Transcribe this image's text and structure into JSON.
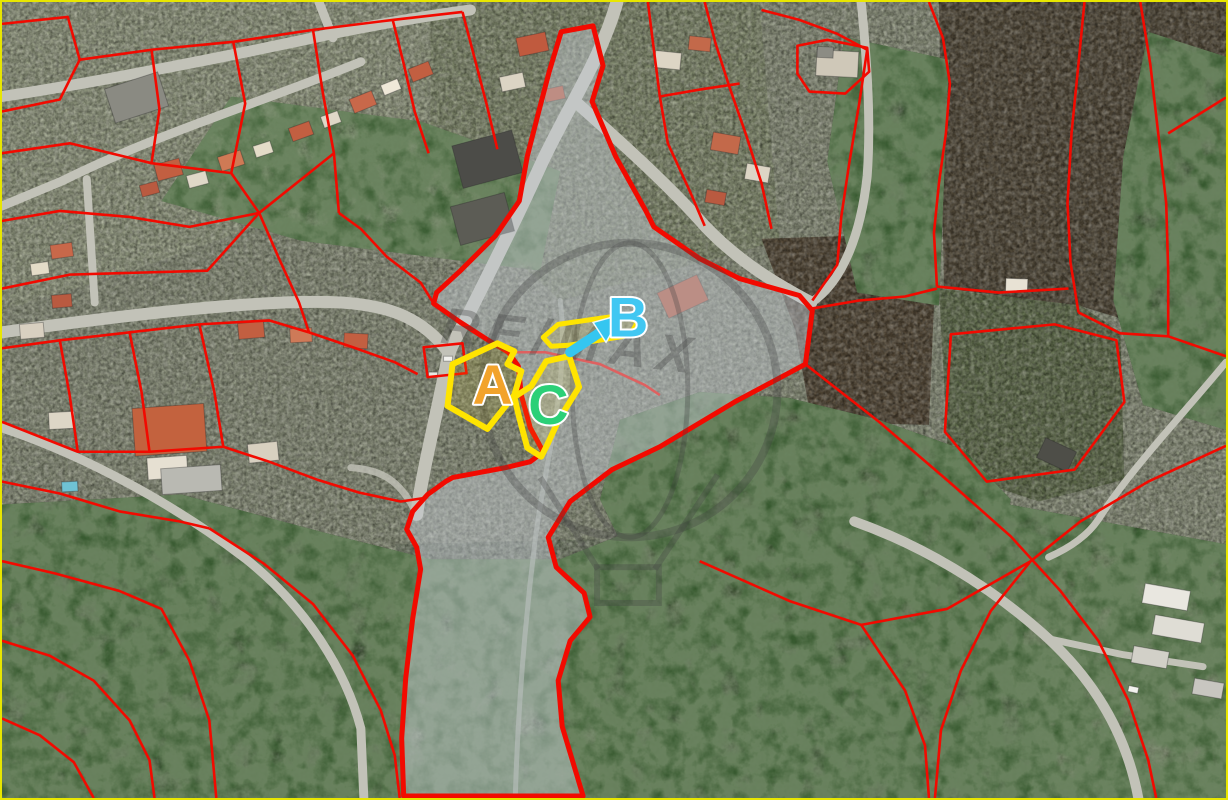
{
  "map": {
    "type": "aerial-cadastral-plan",
    "border_color": "#e8e600",
    "parcel_line_color": "#f20a00",
    "highlight_outline_color": "#ffe400",
    "subject_parcel": {
      "fill": "rgba(198,205,212,0.45)",
      "stroke": "#f20a00"
    },
    "watermark": {
      "text": "RE/MAX",
      "color": "rgba(66,66,66,0.38)",
      "logo": "hot-air-balloon-outline"
    },
    "markers": [
      {
        "id": "A",
        "label": "A",
        "color": "#f2a32b"
      },
      {
        "id": "B",
        "label": "B",
        "color": "#41c7f2",
        "arrow_color": "#35c6f0"
      },
      {
        "id": "C",
        "label": "C",
        "color": "#2bd077"
      }
    ]
  }
}
